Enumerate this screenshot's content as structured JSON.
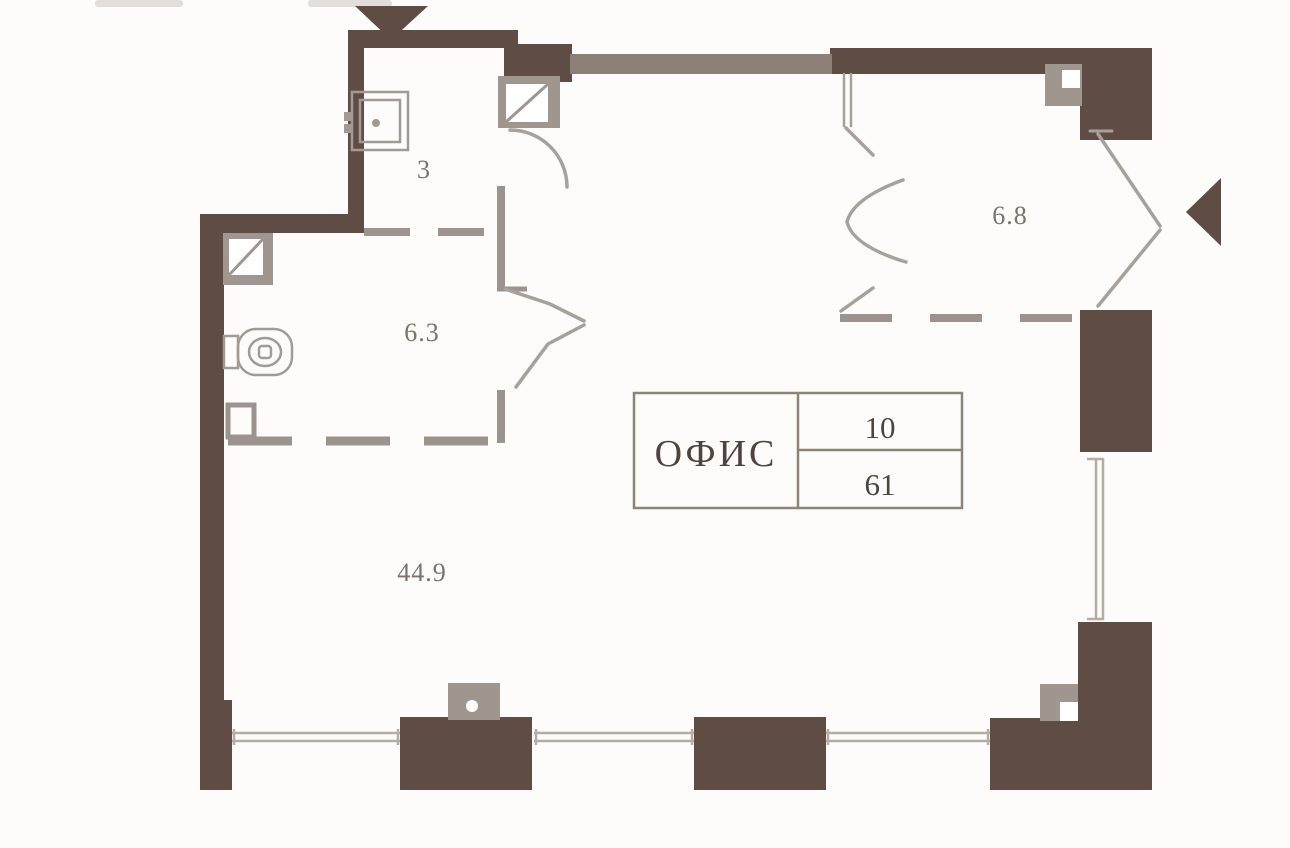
{
  "page": {
    "kind": "architectural-floor-plan",
    "description": "Office unit floor plan with entrance arrows, sanitary rooms and window wall"
  },
  "colors": {
    "background": "#fdfcfb",
    "wall": "#5f4c45",
    "wall_light": "#8d8078",
    "shaft": "#a09690",
    "partition": "#9c938e",
    "door_line": "#a8a09b",
    "window_line": "#b5aca6",
    "fixture_line": "#a39a95",
    "label": "#7d716a",
    "table_text": "#4f443d",
    "table_line": "#8d837b",
    "artifact": "#d9d4d0"
  },
  "labels": {
    "room_3": "3",
    "room_6_3": "6.3",
    "room_6_8": "6.8",
    "room_44_9": "44.9"
  },
  "office_table": {
    "name": "ОФИС",
    "unit_number": "10",
    "area_m2": "61"
  },
  "icons": {
    "top_entrance": "down-triangle-entrance-arrow",
    "right_entrance": "left-triangle-entrance-arrow",
    "sink": "sink-top-view",
    "toilet": "toilet-top-view",
    "shaft_squares": "column-shaft-with-diagonal"
  }
}
